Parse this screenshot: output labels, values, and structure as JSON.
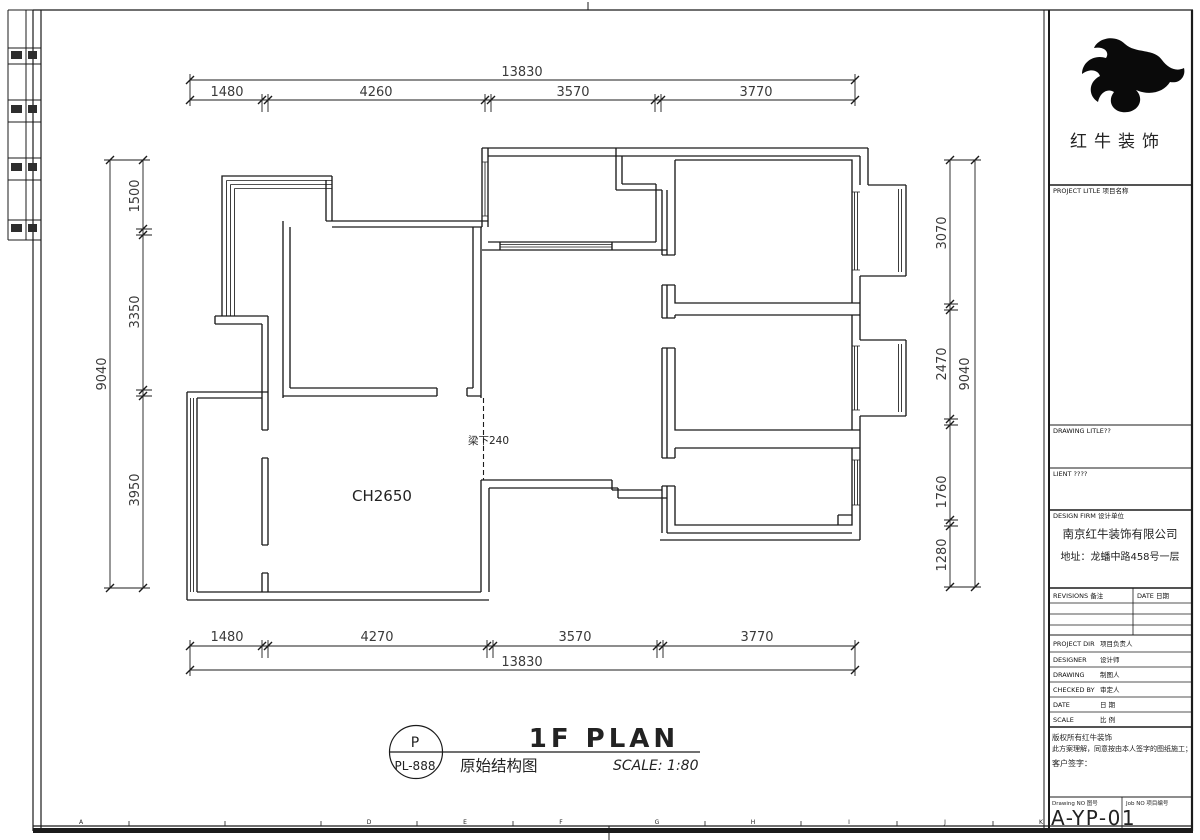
{
  "title_block": {
    "company_name": "红牛装饰",
    "project_title_label": "PROJECT LITLE 项目名称",
    "drawing_title_label": "DRAWING LITLE??",
    "client_label": "LIENT ????",
    "design_firm_label": "DESIGN FIRM 设计单位",
    "design_firm_name": "南京红牛装饰有限公司",
    "design_firm_address": "地址：龙蟠中路458号一层",
    "revisions_label": "REVISIONS 备注",
    "revisions_date_label": "DATE 日期",
    "rows": [
      {
        "en": "PROJECT DIR",
        "cn": "项目负责人"
      },
      {
        "en": "DESIGNER",
        "cn": "设计师"
      },
      {
        "en": "DRAWING",
        "cn": "制图人"
      },
      {
        "en": "CHECKED BY",
        "cn": "审定人"
      },
      {
        "en": "DATE",
        "cn": "日 期"
      },
      {
        "en": "SCALE",
        "cn": "比 例"
      }
    ],
    "copyright_line1": "版权所有红牛装饰",
    "copyright_line2": "此方案理解，同意按由本人签字的图纸施工；",
    "client_sign_label": "客户签字：",
    "drawing_no_label": "Drawing NO 图号",
    "job_no_label": "Job NO 项目编号",
    "drawing_no": "A-YP-01"
  },
  "plan": {
    "ceiling_height_label": "CH2650",
    "beam_label": "梁下240"
  },
  "titlebar": {
    "plan_name": "1F PLAN",
    "drawing_name": "原始结构图",
    "scale_text": "SCALE: 1:80",
    "badge_top": "P",
    "badge_bottom": "PL-888"
  },
  "dimensions": {
    "top": {
      "total": "13830",
      "segments": [
        "1480",
        "4260",
        "3570",
        "3770"
      ]
    },
    "bottom": {
      "total": "13830",
      "segments": [
        "1480",
        "4270",
        "3570",
        "3770"
      ]
    },
    "left": {
      "total": "9040",
      "segments": [
        "1500",
        "3350",
        "3950"
      ]
    },
    "right": {
      "total": "9040",
      "segments": [
        "3070",
        "2470",
        "1760",
        "1280"
      ]
    }
  },
  "frame": {
    "grid_letters": [
      "A",
      "D",
      "E",
      "F",
      "G",
      "H",
      "I",
      "J",
      "K"
    ]
  }
}
